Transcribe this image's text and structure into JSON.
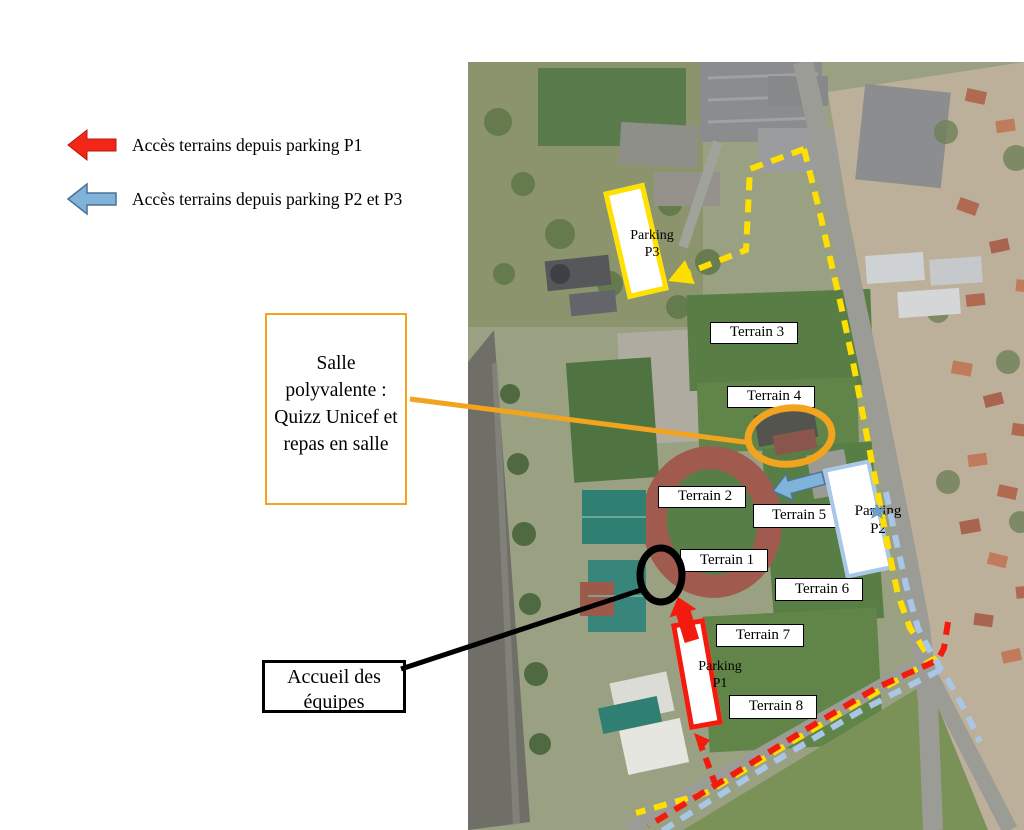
{
  "legend": {
    "items": [
      {
        "id": "p1",
        "label": "Accès terrains depuis parking P1",
        "arrow_color": "#f22718"
      },
      {
        "id": "p2_p3",
        "label": "Accès terrains depuis parking P2 et P3",
        "arrow_color": "#7fb3d9"
      }
    ]
  },
  "callouts": {
    "salle": {
      "lines": [
        "Salle",
        "polyvalente :",
        "Quizz Unicef et",
        "repas en salle"
      ],
      "border_color": "#f2a41f"
    },
    "accueil": {
      "lines": [
        "Accueil des",
        "équipes"
      ],
      "border_color": "#000000"
    }
  },
  "map": {
    "terrains": [
      {
        "label": "Terrain 1"
      },
      {
        "label": "Terrain 2"
      },
      {
        "label": "Terrain 3"
      },
      {
        "label": "Terrain 4"
      },
      {
        "label": "Terrain 5"
      },
      {
        "label": "Terrain 6"
      },
      {
        "label": "Terrain 7"
      },
      {
        "label": "Terrain 8"
      }
    ],
    "parkings": [
      {
        "id": "P3",
        "lines": [
          "Parking",
          "P3"
        ],
        "border_color": "#ffe100"
      },
      {
        "id": "P2",
        "lines": [
          "Parking",
          "P2"
        ],
        "border_color": "#a9c7e8"
      },
      {
        "id": "P1",
        "lines": [
          "Parking",
          "P1"
        ],
        "border_color": "#f21b0e"
      }
    ]
  },
  "colors": {
    "route_p1_red": "#f21b0e",
    "route_p2_p3_blue": "#a9c6e6",
    "route_p3_yellow": "#ffdf00",
    "highlight_orange": "#f2a41f",
    "legend_red": "#f22718",
    "legend_blue": "#7fb3d9"
  }
}
